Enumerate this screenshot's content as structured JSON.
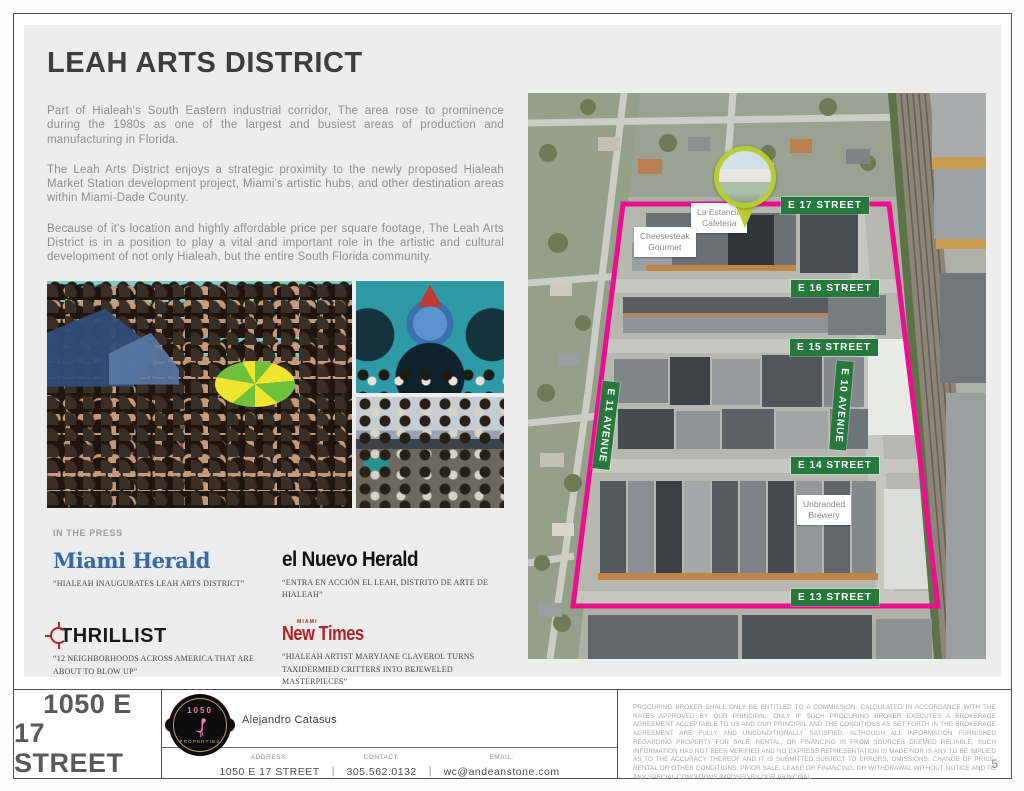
{
  "header": {
    "title": "LEAH ARTS DISTRICT"
  },
  "intro": {
    "p1": "Part of Hialeah's South Eastern industrial corridor, The area rose to prominence during the 1980s as one of the largest and busiest areas of production and manufacturing in Florida.",
    "p2": "The Leah Arts District enjoys a strategic proximity to the newly proposed Hialeah Market Station development project, Miami's artistic hubs, and other destination areas within Miami-Dade County.",
    "p3": "Because of it's location and highly affordable price per square footage, The Leah Arts District is in a position to play a vital and important role in the artistic and cultural development of not only Hialeah, but the entire South Florida community."
  },
  "press": {
    "heading": "IN THE PRESS",
    "items": [
      {
        "outlet": "Miami Herald",
        "quote": "“HIALEAH INAUGURATES LEAH ARTS DISTRICT”"
      },
      {
        "outlet": "el Nuevo Herald",
        "quote": "“ENTRA EN ACCIÓN EL LEAH, DISTRITO DE ARTE DE HIALEAH”"
      },
      {
        "outlet": "THRILLIST",
        "quote": "“12 NEIGHBORHOODS ACROSS AMERICA THAT ARE ABOUT TO BLOW UP”"
      },
      {
        "outlet": "New Times",
        "kicker": "MIAMI",
        "quote": "“HIALEAH ARTIST MARYJANE CLAVEROL TURNS TAXIDERMIED CRITTERS INTO BEJEWELED MASTERPIECES”"
      }
    ]
  },
  "map": {
    "street_labels": [
      "E 17 STREET",
      "E 16 STREET",
      "E 15 STREET",
      "E 14 STREET",
      "E 13 STREET"
    ],
    "avenue_labels": [
      "E 11 AVENUE",
      "E 10 AVENUE"
    ],
    "pois": [
      {
        "line1": "La Estancia",
        "line2": "Cafeteria"
      },
      {
        "line1": "Cheesesteak",
        "line2": "Gourmet"
      },
      {
        "line1": "Unbranded",
        "line2": "Brewery"
      }
    ],
    "boundary_color": "#ec0e8e",
    "sign_color": "#26793c",
    "pin_color": "#b8cc33"
  },
  "footer": {
    "property_title_line1": "1050 E",
    "property_title_line2": "17 STREET",
    "logo": {
      "top": "1050",
      "bottom": "PROPERTIES"
    },
    "agent": "Alejandro Catasus",
    "separator": "|",
    "contacts": [
      {
        "label": "ADDRESS:",
        "value": "1050 E 17 STREET"
      },
      {
        "label": "CONTACT:",
        "value": "305.562.0132"
      },
      {
        "label": "EMAIL:",
        "value": "wc@andeanstone.com"
      }
    ],
    "legal": "PROCURING BROKER SHALL ONLY BE ENTITLED TO A COMMISSION, CALCULATED IN ACCORDANCE WITH THE RATES APPROVED BY OUR PRINCIPAL, ONLY IF SUCH PROCURING BROKER EXECUTES A BROKERAGE AGREEMENT ACCEPTABLE TO US AND OUR PRINCIPAL AND THE CONDITIONS AS SET FORTH IN THE BROKERAGE AGREEMENT ARE FULLY AND UNCONDITIONALLY SATISFIED. ALTHOUGH ALL INFORMATION FURNISHED REGARDING PROPERTY FOR SALE, RENTAL, OR FINANCING IS FROM SOURCES DEEMED RELIABLE, SUCH INFORMATION HAS NOT BEEN VERIFIED AND NO EXPRESS REPRESENTATION IS MADE NOR IS ANY TO BE IMPLIED AS TO THE ACCURACY THEREOF AND IT IS SUBMITTED SUBJECT TO ERRORS, OMISSIONS, CHANGE OF PRICE, RENTAL OR OTHER CONDITIONS, PRIOR SALE, LEASE OR FINANCING, OR WITHDRAWAL WITHOUT NOTICE AND TO ANY SPECIAL CONDITIONS IMPOSED BY OUR PRINCIPAL.",
    "page_number": "5"
  }
}
